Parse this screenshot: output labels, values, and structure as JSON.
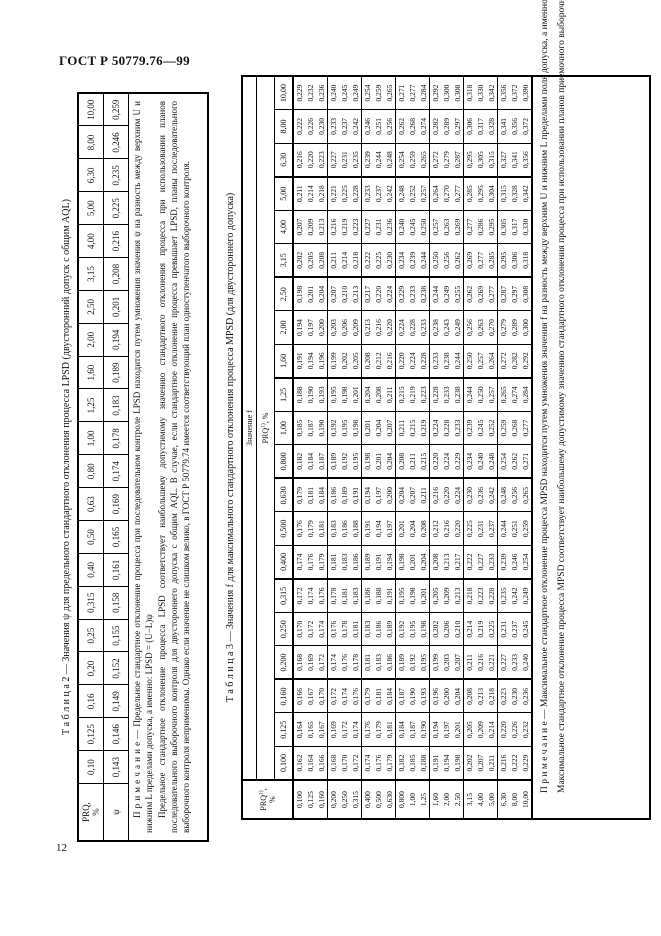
{
  "page": {
    "header": "ГОСТ Р 50779.76—99",
    "page_number": "12"
  },
  "colors": {
    "ink": "#111111",
    "paper": "#ffffff"
  },
  "table2": {
    "title": "Т а б л и ц а  2 — Значения ψ для предельного стандартного отклонения процесса LPSD (двусторонний допуск с общим AQL)",
    "corner": {
      "line1": "PRQ,",
      "line2": "%"
    },
    "psi_label": "ψ",
    "prq_values": [
      "0,10",
      "0,125",
      "0,16",
      "0,20",
      "0,25",
      "0,315",
      "0,40",
      "0,50",
      "0,63",
      "0,80",
      "1,00",
      "1,25",
      "1,60",
      "2,00",
      "2,50",
      "3,15",
      "4,00",
      "5,00",
      "6,30",
      "8,00",
      "10,00"
    ],
    "psi_values": [
      "0,143",
      "0,146",
      "0,149",
      "0,152",
      "0,155",
      "0,158",
      "0,161",
      "0,165",
      "0,169",
      "0,174",
      "0,178",
      "0,183",
      "0,189",
      "0,194",
      "0,201",
      "0,208",
      "0,216",
      "0,225",
      "0,235",
      "0,246",
      "0,259"
    ],
    "note": [
      "П р и м е ч а н и е — Предельное стандартное отклонение процесса при последовательном контроле LPSD находится путем умножения значения ψ на разность между верхним U и нижним L пределами допуска, а именно: LPSD = (U−L)ψ",
      "Предельное стандартное отклонение процесса LPSD соответствует наибольшему допустимому значению стандартного отклонения процесса при использовании планов последовательного выборочного контроля для двустороннего допуска с общим AQL. В случае, если стандартное отклонение процесса превышает LPSD, планы последовательного выборочного контроля неприменимы. Однако если значение не слишком велико, в ГОСТ Р 50779.74 имеется соответствующий план одноступенчатого выборочного контроля."
    ]
  },
  "table3": {
    "title": "Т а б л и ц а  3 — Значения f для максимального стандартного отклонения процесса MPSD (для двустороннего допуска)",
    "corner": {
      "base": "PRQ",
      "sup": "1)",
      "comma": ",",
      "line2": "%"
    },
    "value_header": "Значение f",
    "sub_header": {
      "base": "PRQ",
      "sup": "1)",
      "rest": ", %"
    },
    "col_values": [
      "0,100",
      "0,125",
      "0,160",
      "0,200",
      "0,250",
      "0,315",
      "0,400",
      "0,500",
      "0,630",
      "0,800",
      "1,00",
      "1,25",
      "1,60",
      "2,00",
      "2,50",
      "3,15",
      "4,00",
      "5,00",
      "6,30",
      "8,00",
      "10,00"
    ],
    "rows": [
      {
        "prq": "0,100",
        "f": [
          "0,162",
          "0,164",
          "0,166",
          "0,168",
          "0,170",
          "0,172",
          "0,174",
          "0,176",
          "0,179",
          "0,182",
          "0,185",
          "0,188",
          "0,191",
          "0,194",
          "0,198",
          "0,202",
          "0,207",
          "0,211",
          "0,216",
          "0,222",
          "0,229"
        ]
      },
      {
        "prq": "0,125",
        "f": [
          "0,164",
          "0,165",
          "0,167",
          "0,169",
          "0,172",
          "0,174",
          "0,176",
          "0,179",
          "0,181",
          "0,184",
          "0,187",
          "0,190",
          "0,194",
          "0,197",
          "0,201",
          "0,205",
          "0,209",
          "0,214",
          "0,220",
          "0,226",
          "0,232"
        ]
      },
      {
        "prq": "0,160",
        "f": [
          "0,166",
          "0,167",
          "0,170",
          "0,172",
          "0,174",
          "0,176",
          "0,179",
          "0,181",
          "0,184",
          "0,187",
          "0,190",
          "0,193",
          "0,196",
          "0,200",
          "0,204",
          "0,208",
          "0,213",
          "0,218",
          "0,223",
          "0,230",
          "0,236"
        ]
      },
      {
        "prq": "0,200",
        "f": [
          "0,168",
          "0,169",
          "0,172",
          "0,174",
          "0,176",
          "0,178",
          "0,181",
          "0,183",
          "0,186",
          "0,189",
          "0,192",
          "0,195",
          "0,199",
          "0,203",
          "0,207",
          "0,211",
          "0,216",
          "0,221",
          "0,227",
          "0,233",
          "0,240"
        ]
      },
      {
        "prq": "0,250",
        "f": [
          "0,170",
          "0,172",
          "0,174",
          "0,176",
          "0,178",
          "0,181",
          "0,183",
          "0,186",
          "0,189",
          "0,192",
          "0,195",
          "0,198",
          "0,202",
          "0,206",
          "0,210",
          "0,214",
          "0,219",
          "0,225",
          "0,231",
          "0,237",
          "0,245"
        ]
      },
      {
        "prq": "0,315",
        "f": [
          "0,172",
          "0,174",
          "0,176",
          "0,178",
          "0,181",
          "0,183",
          "0,186",
          "0,188",
          "0,191",
          "0,195",
          "0,198",
          "0,201",
          "0,205",
          "0,209",
          "0,213",
          "0,218",
          "0,223",
          "0,228",
          "0,235",
          "0,242",
          "0,249"
        ]
      },
      {
        "prq": "0,400",
        "f": [
          "0,174",
          "0,176",
          "0,179",
          "0,181",
          "0,183",
          "0,186",
          "0,189",
          "0,191",
          "0,194",
          "0,198",
          "0,201",
          "0,204",
          "0,208",
          "0,213",
          "0,217",
          "0,222",
          "0,227",
          "0,233",
          "0,239",
          "0,246",
          "0,254"
        ]
      },
      {
        "prq": "0,500",
        "f": [
          "0,176",
          "0,179",
          "0,181",
          "0,183",
          "0,186",
          "0,188",
          "0,191",
          "0,194",
          "0,197",
          "0,201",
          "0,204",
          "0,208",
          "0,212",
          "0,216",
          "0,220",
          "0,225",
          "0,231",
          "0,237",
          "0,244",
          "0,251",
          "0,259"
        ]
      },
      {
        "prq": "0,630",
        "f": [
          "0,179",
          "0,181",
          "0,184",
          "0,186",
          "0,189",
          "0,191",
          "0,194",
          "0,197",
          "0,200",
          "0,204",
          "0,207",
          "0,211",
          "0,216",
          "0,220",
          "0,224",
          "0,230",
          "0,236",
          "0,242",
          "0,248",
          "0,256",
          "0,265"
        ]
      },
      {
        "prq": "0,800",
        "f": [
          "0,182",
          "0,184",
          "0,187",
          "0,189",
          "0,192",
          "0,195",
          "0,198",
          "0,201",
          "0,204",
          "0,208",
          "0,211",
          "0,215",
          "0,220",
          "0,224",
          "0,229",
          "0,234",
          "0,240",
          "0,248",
          "0,254",
          "0,262",
          "0,271"
        ]
      },
      {
        "prq": "1,00",
        "f": [
          "0,185",
          "0,187",
          "0,190",
          "0,192",
          "0,195",
          "0,198",
          "0,201",
          "0,204",
          "0,207",
          "0,211",
          "0,215",
          "0,219",
          "0,224",
          "0,228",
          "0,233",
          "0,239",
          "0,245",
          "0,252",
          "0,259",
          "0,268",
          "0,277"
        ]
      },
      {
        "prq": "1,25",
        "f": [
          "0,188",
          "0,190",
          "0,193",
          "0,195",
          "0,198",
          "0,201",
          "0,204",
          "0,208",
          "0,211",
          "0,215",
          "0,219",
          "0,223",
          "0,228",
          "0,233",
          "0,238",
          "0,244",
          "0,250",
          "0,257",
          "0,265",
          "0,274",
          "0,284"
        ]
      },
      {
        "prq": "1,60",
        "f": [
          "0,191",
          "0,194",
          "0,196",
          "0,199",
          "0,202",
          "0,205",
          "0,208",
          "0,212",
          "0,216",
          "0,220",
          "0,224",
          "0,228",
          "0,233",
          "0,238",
          "0,244",
          "0,250",
          "0,257",
          "0,264",
          "0,272",
          "0,282",
          "0,292"
        ]
      },
      {
        "prq": "2,00",
        "f": [
          "0,194",
          "0,197",
          "0,200",
          "0,203",
          "0,206",
          "0,209",
          "0,213",
          "0,216",
          "0,220",
          "0,224",
          "0,228",
          "0,233",
          "0,238",
          "0,243",
          "0,249",
          "0,256",
          "0,263",
          "0,270",
          "0,279",
          "0,289",
          "0,300"
        ]
      },
      {
        "prq": "2,50",
        "f": [
          "0,198",
          "0,201",
          "0,204",
          "0,207",
          "0,210",
          "0,213",
          "0,217",
          "0,220",
          "0,224",
          "0,229",
          "0,233",
          "0,238",
          "0,244",
          "0,249",
          "0,255",
          "0,262",
          "0,269",
          "0,277",
          "0,287",
          "0,297",
          "0,308"
        ]
      },
      {
        "prq": "3,15",
        "f": [
          "0,202",
          "0,205",
          "0,208",
          "0,211",
          "0,214",
          "0,218",
          "0,222",
          "0,225",
          "0,230",
          "0,234",
          "0,239",
          "0,244",
          "0,250",
          "0,256",
          "0,262",
          "0,269",
          "0,277",
          "0,285",
          "0,295",
          "0,306",
          "0,318"
        ]
      },
      {
        "prq": "4,00",
        "f": [
          "0,207",
          "0,209",
          "0,213",
          "0,216",
          "0,219",
          "0,223",
          "0,227",
          "0,231",
          "0,236",
          "0,240",
          "0,245",
          "0,250",
          "0,257",
          "0,263",
          "0,269",
          "0,277",
          "0,286",
          "0,295",
          "0,305",
          "0,317",
          "0,330"
        ]
      },
      {
        "prq": "5,00",
        "f": [
          "0,211",
          "0,214",
          "0,218",
          "0,221",
          "0,225",
          "0,228",
          "0,233",
          "0,237",
          "0,242",
          "0,248",
          "0,252",
          "0,257",
          "0,264",
          "0,270",
          "0,277",
          "0,285",
          "0,295",
          "0,304",
          "0,315",
          "0,328",
          "0,342"
        ]
      },
      {
        "prq": "6,30",
        "f": [
          "0,216",
          "0,220",
          "0,223",
          "0,227",
          "0,231",
          "0,235",
          "0,239",
          "0,244",
          "0,248",
          "0,254",
          "0,259",
          "0,265",
          "0,272",
          "0,279",
          "0,287",
          "0,295",
          "0,305",
          "0,315",
          "0,327",
          "0,341",
          "0,356"
        ]
      },
      {
        "prq": "8,00",
        "f": [
          "0,222",
          "0,226",
          "0,230",
          "0,233",
          "0,237",
          "0,242",
          "0,246",
          "0,251",
          "0,256",
          "0,262",
          "0,268",
          "0,274",
          "0,282",
          "0,289",
          "0,297",
          "0,306",
          "0,317",
          "0,328",
          "0,341",
          "0,356",
          "0,372"
        ]
      },
      {
        "prq": "10,00",
        "f": [
          "0,229",
          "0,232",
          "0,236",
          "0,240",
          "0,245",
          "0,249",
          "0,254",
          "0,259",
          "0,265",
          "0,271",
          "0,277",
          "0,284",
          "0,292",
          "0,300",
          "0,308",
          "0,318",
          "0,330",
          "0,342",
          "0,356",
          "0,372",
          "0,390"
        ]
      }
    ],
    "note": [
      "П р и м е ч а н и е — Максимальное стандартное отклонение процесса MPSD находится путем умножения значения f на разность между верхним U и нижним L пределами поля допуска, а именно MPSD = (U−L)f.",
      "Максимальное стандартное отклонение процесса MPSD соответствует наибольшему допустимому значению стандартного отклонения процесса при использовании планов приемочного выборочного контроля для границ двустороннего допуска. Если стандартное отклонение процесса превышает MPSD, все партии должны рассматриваться как неприемлемые."
    ]
  }
}
